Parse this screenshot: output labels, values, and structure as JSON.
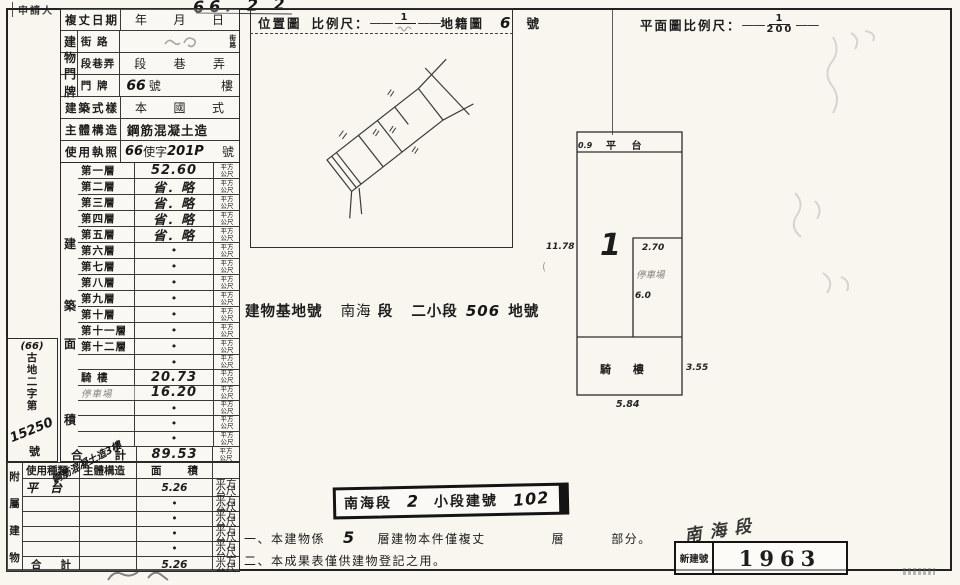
{
  "header": {
    "applicant": "申請人",
    "date_label": "複丈日期",
    "date_hand": "66. 2 2",
    "year": "年",
    "month": "月",
    "day": "日"
  },
  "address": {
    "group": [
      "建",
      "物",
      "門",
      "牌"
    ],
    "street_label": "街 路",
    "street_stack_top": "街",
    "street_stack_bottom": "路",
    "lane_label": "段巷弄",
    "lane_seg": "段",
    "lane_alley": "巷",
    "lane_sub": "弄",
    "plate_label": "門 牌",
    "plate_hand": "66",
    "plate_no": "號",
    "plate_floor": "樓"
  },
  "rows_top": {
    "style_label": "建築式樣",
    "style_v1": "本",
    "style_v2": "國",
    "style_v3": "式",
    "structure_label": "主體構造",
    "structure_value": "鋼筋混凝土造",
    "license_label": "使用執照",
    "license_hand1": "66",
    "license_print": "使字",
    "license_hand2": "201P",
    "license_suffix": "號"
  },
  "area_table": {
    "group": [
      "建",
      "築",
      "面",
      "積"
    ],
    "unit_top": "平方",
    "unit_bottom": "公尺",
    "rows": [
      {
        "name": "第一層",
        "value": "52.60",
        "vs": "hand"
      },
      {
        "name": "第二層",
        "value": "省．略",
        "vs": "hand"
      },
      {
        "name": "第三層",
        "value": "省．略",
        "vs": "hand"
      },
      {
        "name": "第四層",
        "value": "省．略",
        "vs": "hand"
      },
      {
        "name": "第五層",
        "value": "省．略",
        "vs": "hand"
      },
      {
        "name": "第六層",
        "value": "•",
        "vs": "dot"
      },
      {
        "name": "第七層",
        "value": "•",
        "vs": "dot"
      },
      {
        "name": "第八層",
        "value": "•",
        "vs": "dot"
      },
      {
        "name": "第九層",
        "value": "•",
        "vs": "dot"
      },
      {
        "name": "第十層",
        "value": "•",
        "vs": "dot"
      },
      {
        "name": "第十一層",
        "value": "•",
        "vs": "dot"
      },
      {
        "name": "第十二層",
        "value": "•",
        "vs": "dot"
      },
      {
        "name": "",
        "value": "•",
        "vs": "dot"
      },
      {
        "name": "騎 樓",
        "value": "20.73",
        "vs": "hand"
      },
      {
        "name": "停車場",
        "value": "16.20",
        "vs": "hand",
        "ns": "hand-faint"
      },
      {
        "name": "",
        "value": "•",
        "vs": "dot"
      },
      {
        "name": "",
        "value": "•",
        "vs": "dot"
      },
      {
        "name": "",
        "value": "•",
        "vs": "dot"
      }
    ],
    "total_label_1": "合",
    "total_label_2": "計",
    "total_value": "89.53"
  },
  "side_note": {
    "line1": "(66)",
    "chars": [
      "古",
      "地",
      "二",
      "字",
      "第"
    ],
    "number": "15250",
    "suffix": "號"
  },
  "annex": {
    "vertical": [
      "附",
      "屬",
      "建",
      "物"
    ],
    "h_use": "使用種類",
    "h_structure": "主體構造",
    "h_area_1": "面",
    "h_area_2": "積",
    "row1_use": "平 台",
    "row1_structure_diag": "鋼筋混凝土造3樓",
    "row1_area": "5.26",
    "dot": "•",
    "total_label_1": "合",
    "total_label_2": "計",
    "total_value": "5.26",
    "page_mark": "(2)"
  },
  "location": {
    "title": "位置圖",
    "scale_label": "比例尺：",
    "numerator": "1",
    "cadastre_label": "地籍圖",
    "sheet": "6",
    "suffix": "號"
  },
  "plan": {
    "title": "平面圖比例尺：",
    "numerator": "1",
    "denominator": "200",
    "platform_label": "平 台",
    "platform_w": "0.9",
    "left_dim": "11.78",
    "unit_no": "1",
    "inner_w": "2.70",
    "inner_label": "停車場",
    "inner_h": "6.0",
    "arcade_label": "騎 樓",
    "arcade_d": "3.55",
    "bottom_dim": "5.84"
  },
  "site_line": {
    "label": "建物基地號",
    "sec": "南海",
    "sec2": "段",
    "sub": "二小段",
    "lot": "506",
    "suffix": "地號"
  },
  "bldg_box": {
    "p1": "南海段",
    "hand1": "2",
    "p2": "小段建號",
    "hand2": "102"
  },
  "notes": {
    "n1a": "一、本建物係",
    "n1_hand": "5",
    "n1b": "層建物本件僅複丈",
    "n1c": "層",
    "n1d": "部分。",
    "n2": "二、本成果表僅供建物登記之用。"
  },
  "stamp": {
    "hand": "南海段",
    "label": "新建號",
    "number": "1963"
  }
}
